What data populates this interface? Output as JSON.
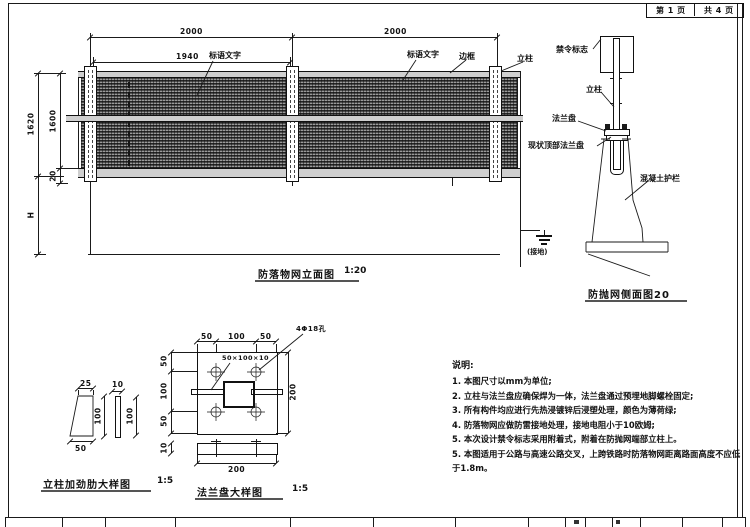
{
  "page": {
    "sheet_no": "第 1 页",
    "sheet_total": "共 4 页"
  },
  "elevation": {
    "caption": "防落物网立面图",
    "scale": "1:20",
    "dim_span1": "2000",
    "dim_span2": "2000",
    "dim_inner": "1940",
    "dim_height_total": "1620",
    "dim_height_net": "1600",
    "dim_rail": "20",
    "dim_below": "H",
    "label_slogan1": "标语文字",
    "label_slogan2": "标语文字",
    "label_frame": "边框",
    "label_post": "立柱",
    "label_ground": "(接地)"
  },
  "side_view": {
    "caption": "防抛网侧面图20",
    "label_sign": "禁令标志",
    "label_post": "立柱",
    "label_flange": "法兰盘",
    "label_existing_flange": "现状顶部法兰盘",
    "label_barrier": "混凝土护栏"
  },
  "stiffener_detail": {
    "caption": "立柱加劲肋大样图",
    "scale": "1:5",
    "dim_top": "25",
    "dim_bottom": "50",
    "dim_height_a": "100",
    "dim_thickness": "10",
    "dim_height_b": "100"
  },
  "flange_detail": {
    "caption": "法兰盘大样图",
    "scale": "1:5",
    "label_holes": "4Φ18孔",
    "label_stiffener_size": "50×100×10",
    "dim_top_left": "50",
    "dim_top_mid": "100",
    "dim_top_right": "50",
    "dim_left_top": "50",
    "dim_left_mid": "100",
    "dim_left_bottom": "50",
    "dim_right": "200",
    "dim_side_thickness": "10",
    "dim_side_width": "200"
  },
  "notes": {
    "title": "说明:",
    "items": [
      "1. 本图尺寸以mm为单位;",
      "2. 立柱与法兰盘应确保焊为一体，法兰盘通过预埋地脚螺栓固定;",
      "3. 所有构件均应进行先热浸镀锌后浸塑处理，颜色为薄荷绿;",
      "4. 防落物网应做防雷接地处理，接地电阻小于10欧姆;",
      "5. 本次设计禁令标志采用附着式，附着在防抛网端部立柱上。",
      "5. 本图适用于公路与高速公路交叉，上跨铁路时防落物网距离路面高度不应低于1.8m。"
    ]
  },
  "colors": {
    "line": "#1a1a1a",
    "mesh_dark": "#3c3c3c",
    "mesh_light": "#8a8a8a",
    "paper": "#ffffff"
  }
}
